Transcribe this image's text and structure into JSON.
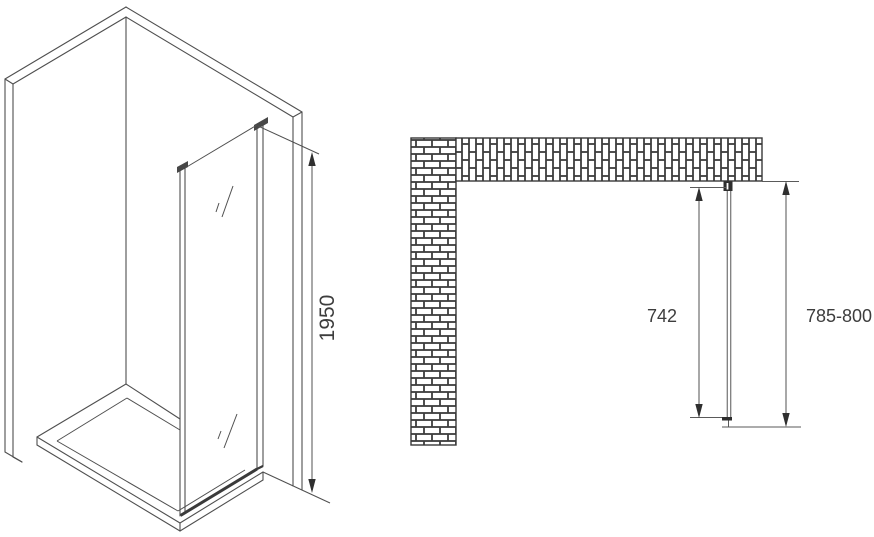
{
  "drawing": {
    "kind": "shower-side-panel installation diagram",
    "views": {
      "isometric": {
        "description": "corner walls with shower tray and fixed glass panel"
      },
      "plan": {
        "description": "top view with brick walls and glass panel"
      }
    }
  },
  "dimensions": {
    "panel_height": {
      "value": "1950",
      "view": "isometric",
      "orientation": "vertical"
    },
    "glass_width": {
      "value": "742",
      "view": "plan"
    },
    "overall_width": {
      "value": "785-800",
      "view": "plan"
    }
  },
  "colors": {
    "background": "#ffffff",
    "line": "#4f4f4f",
    "dimension_line": "#6e6e6e",
    "arrow": "#2f2f2f",
    "text": "#3d3d3d",
    "mortar": "#3d3d3d",
    "brick_fill": "#ffffff",
    "bracket": "#2e2e2e",
    "glass_line": "#7d7d7d"
  }
}
